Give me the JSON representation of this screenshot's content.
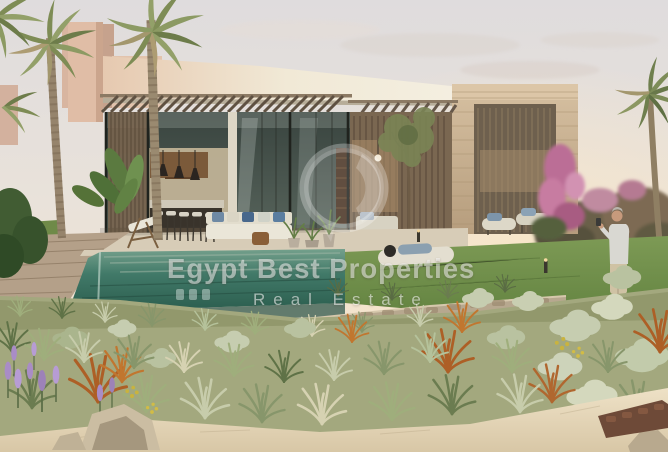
{
  "image": {
    "kind": "real-estate-architectural-rendering",
    "description": "Modern single-storey villa at sunset with wooden pergola, glass facade, stone pavilion, infinity swimming pool, lawn, palm trees, desert-style grasses and a man standing in the garden"
  },
  "watermark": {
    "title": "Egypt Best Properties",
    "subtitle": "Real Estate",
    "logo_shape": "translucent-circular-badge",
    "text_color": "rgba(255,255,255,0.55)"
  },
  "palette": {
    "sky_top": "#dfdcdc",
    "sky_horizon": "#f6e8d3",
    "villa_fascia": "#f3ecdc",
    "pink_building": "#e0bda6",
    "pergola_wood": "#5f5142",
    "stone_cladding": "#cbb495",
    "glass": "#46524c",
    "pool_water": "#3c7262",
    "lawn": "#678b44",
    "sand": "#e3d5ba",
    "rust_grass": "#ad6428",
    "sage_shrub": "#c6cdb0",
    "lavender": "#a98cc6",
    "bougainvillea": "#bb6e96"
  }
}
